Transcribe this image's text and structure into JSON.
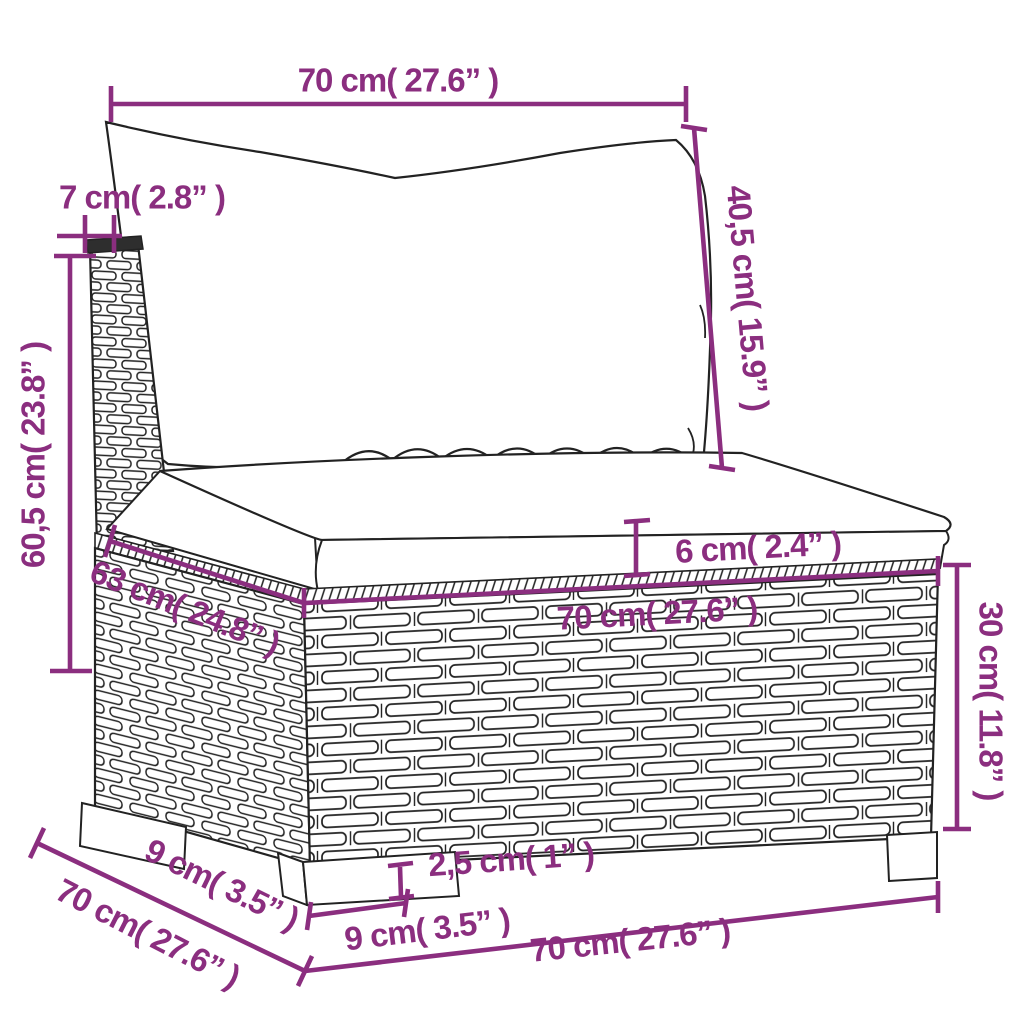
{
  "diagram": {
    "kind": "product-dimension-drawing",
    "subject": "wicker-sofa-section-with-cushions",
    "colors": {
      "dimension_accent": "#8B2E7F",
      "line_art": "#222222",
      "background": "#ffffff"
    },
    "dimensions": {
      "top_width": "70 cm( 27.6” )",
      "post_width": "7 cm( 2.8” )",
      "back_cushion_height": "40,5 cm( 15.9” )",
      "total_height": "60,5 cm( 23.8” )",
      "cushion_thickness": "6 cm( 2.4” )",
      "seat_depth": "63 cm( 24.8” )",
      "seat_width": "70 cm( 27.6” )",
      "base_height": "30 cm( 11.8” )",
      "leg_depth": "9 cm( 3.5” )",
      "total_depth": "70 cm( 27.6” )",
      "leg_height": "2,5 cm( 1” )",
      "leg_width": "9 cm( 3.5” )",
      "base_width": "70 cm( 27.6” )"
    }
  }
}
